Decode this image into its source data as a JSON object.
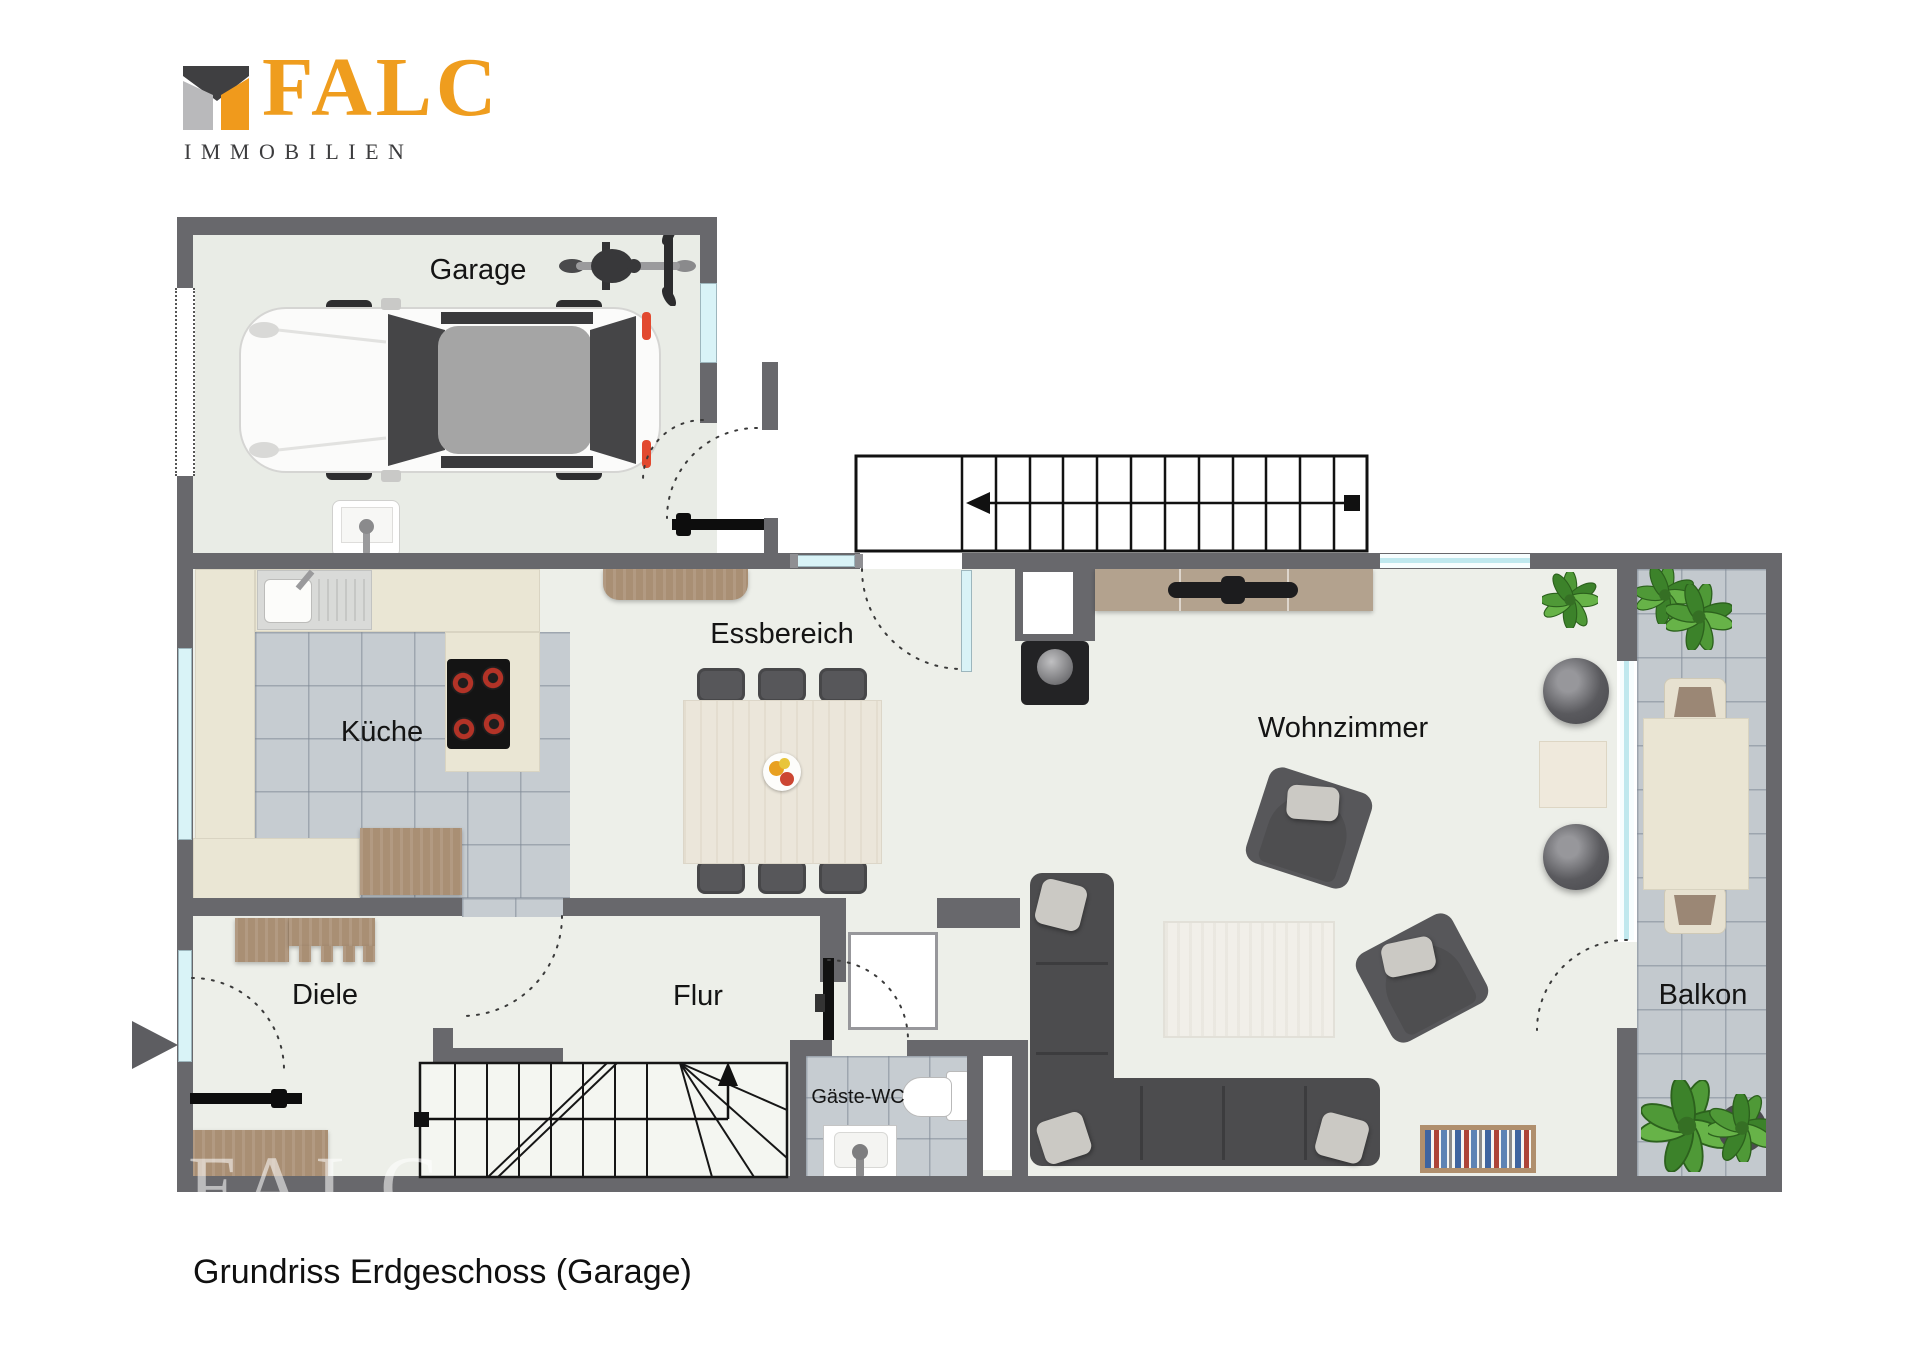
{
  "logo": {
    "brand": "FALC",
    "subtitle": "IMMOBILIEN",
    "accent": "#ef9d1e",
    "dark": "#3c3c3e"
  },
  "caption": "Grundriss Erdgeschoss (Garage)",
  "watermark": "FALC",
  "rooms": {
    "garage": "Garage",
    "kueche": "Küche",
    "essbereich": "Essbereich",
    "wohnzimmer": "Wohnzimmer",
    "diele": "Diele",
    "flur": "Flur",
    "gaeste_wc": "Gäste-WC",
    "balkon": "Balkon"
  },
  "colors": {
    "wall": "#68686c",
    "floor": "#edefe9",
    "tile": "#c6ccd1",
    "window": "#d9f3f7",
    "counter": "#eae6d4",
    "wood": "#a98f74",
    "sofa": "#4c4c4e"
  }
}
